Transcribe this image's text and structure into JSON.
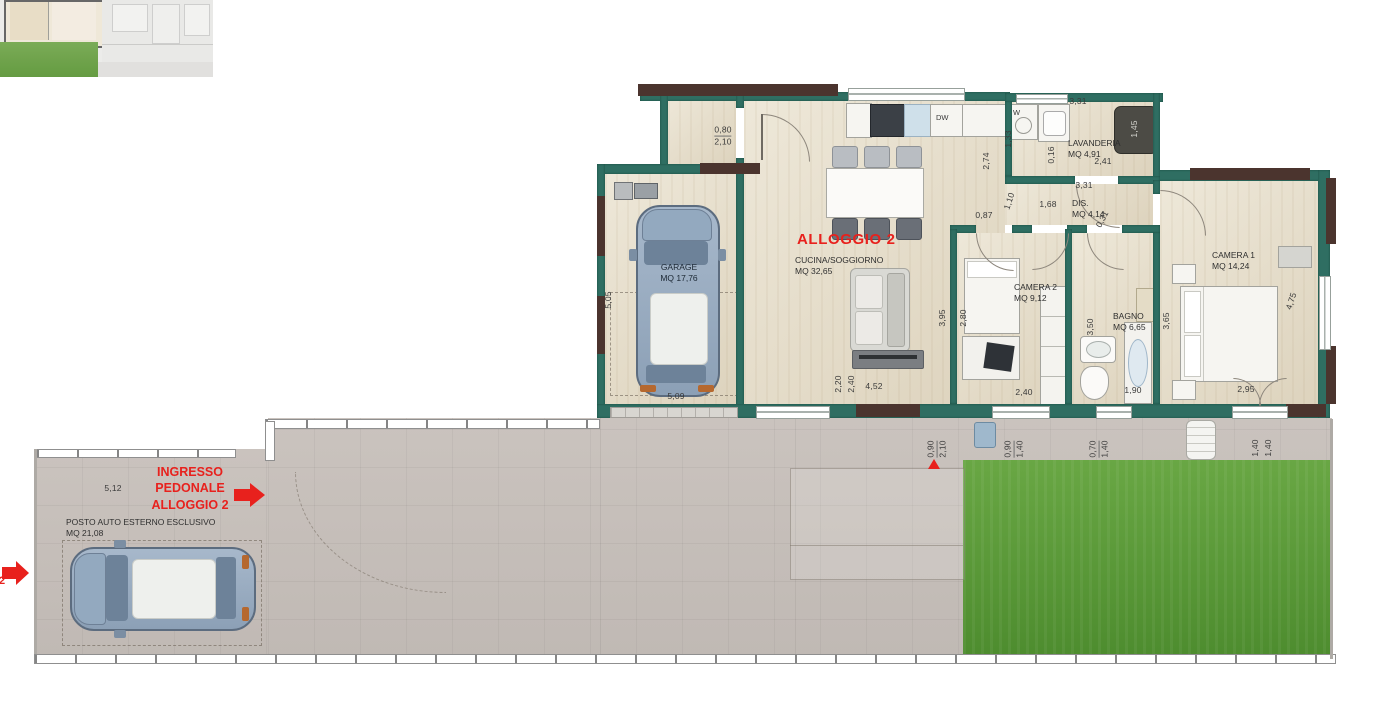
{
  "plan": {
    "title": "ALLOGGIO 2",
    "rooms": {
      "garage": {
        "name": "GARAGE",
        "area": "MQ 17,76"
      },
      "cucina": {
        "name": "CUCINA/SOGGIORNO",
        "area": "MQ 32,65"
      },
      "lavanderia": {
        "name": "LAVANDERIA",
        "area": "MQ 4,91"
      },
      "dis": {
        "name": "DIS.",
        "area": "MQ 4,14"
      },
      "camera2": {
        "name": "CAMERA 2",
        "area": "MQ 9,12"
      },
      "bagno": {
        "name": "BAGNO",
        "area": "MQ 6,65"
      },
      "camera1": {
        "name": "CAMERA 1",
        "area": "MQ 14,24"
      }
    },
    "appliances": {
      "dishwasher": "DW",
      "washer": "W"
    }
  },
  "exterior": {
    "entrance": {
      "line1": "INGRESSO",
      "line2": "PEDONALE",
      "line3": "ALLOGGIO 2"
    },
    "parking": {
      "name": "POSTO AUTO ESTERNO ESCLUSIVO",
      "area": "MQ 21,08"
    },
    "unit_number": "2"
  },
  "colors": {
    "wall_teal": "#2f6e62",
    "lintel_brown": "#4b342e",
    "floor_beige": "#e8e0cc",
    "pavement_grey": "#c6bfba",
    "grass_green": "#5f9e3c",
    "accent_red": "#e8211d",
    "car_blue": "#8ca0b6"
  },
  "dimensions": [
    {
      "t": "5,05",
      "x": 608,
      "y": 300,
      "rot": -90
    },
    {
      "t": "5,09",
      "x": 676,
      "y": 396
    },
    {
      "top": "0,80",
      "bot": "2,10",
      "x": 723,
      "y": 136
    },
    {
      "t": "2,74",
      "x": 986,
      "y": 161,
      "rot": -90
    },
    {
      "t": "1,33",
      "x": 1008,
      "y": 139,
      "rot": -90
    },
    {
      "t": "0,16",
      "x": 1051,
      "y": 155,
      "rot": -90
    },
    {
      "t": "3,31",
      "x": 1078,
      "y": 101
    },
    {
      "t": "2,41",
      "x": 1103,
      "y": 161
    },
    {
      "t": "3,31",
      "x": 1084,
      "y": 185
    },
    {
      "t": "1,45",
      "x": 1134,
      "y": 129,
      "rot": -90,
      "color": "#d8d8d2"
    },
    {
      "t": "1,68",
      "x": 1048,
      "y": 204
    },
    {
      "t": "0,87",
      "x": 984,
      "y": 215
    },
    {
      "t": "1,10",
      "x": 1009,
      "y": 201,
      "rot": -72
    },
    {
      "t": "0,31",
      "x": 1102,
      "y": 219,
      "rot": -62
    },
    {
      "t": "3,95",
      "x": 942,
      "y": 318,
      "rot": -90
    },
    {
      "t": "2,80",
      "x": 963,
      "y": 318,
      "rot": -90
    },
    {
      "t": "2,40",
      "x": 1024,
      "y": 392
    },
    {
      "t": "3,50",
      "x": 1090,
      "y": 327,
      "rot": -90
    },
    {
      "t": "1,90",
      "x": 1133,
      "y": 390
    },
    {
      "t": "3,65",
      "x": 1166,
      "y": 321,
      "rot": -90
    },
    {
      "t": "4,75",
      "x": 1291,
      "y": 301,
      "rot": -72
    },
    {
      "t": "2,95",
      "x": 1246,
      "y": 389
    },
    {
      "t": "2,20",
      "x": 838,
      "y": 384,
      "rot": -90
    },
    {
      "t": "2,40",
      "x": 851,
      "y": 384,
      "rot": -90
    },
    {
      "t": "4,52",
      "x": 874,
      "y": 386
    },
    {
      "top": "0,90",
      "bot": "2,10",
      "x": 937,
      "y": 449,
      "rot": -90
    },
    {
      "top": "0,90",
      "bot": "1,40",
      "x": 1014,
      "y": 449,
      "rot": -90
    },
    {
      "top": "0,70",
      "bot": "1,40",
      "x": 1099,
      "y": 449,
      "rot": -90
    },
    {
      "t": "1,40",
      "x": 1255,
      "y": 448,
      "rot": -90
    },
    {
      "t": "1,40",
      "x": 1268,
      "y": 448,
      "rot": -90
    },
    {
      "t": "5,12",
      "x": 113,
      "y": 488
    }
  ]
}
